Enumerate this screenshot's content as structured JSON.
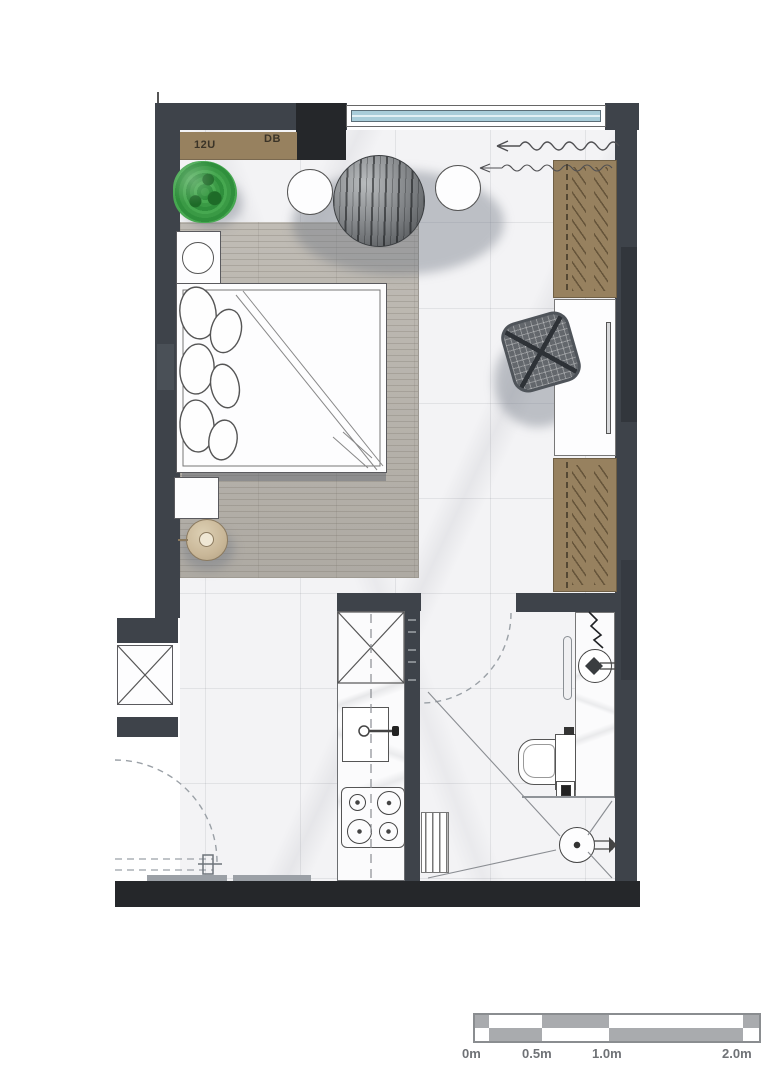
{
  "plan": {
    "type": "studio-apartment-floor-plan",
    "annotations": {
      "cabinet_left_label": "12U",
      "cabinet_right_label": "DB"
    },
    "scale_bar": {
      "labels": [
        "0m",
        "0.5m",
        "1.0m",
        "2.0m"
      ]
    },
    "colors": {
      "wall_gray": "#3e434a",
      "wall_black": "#25272a",
      "wardrobe_brown": "#97815f",
      "wood_floor": "#b7b3ac",
      "marble_floor": "#f3f3f5",
      "window_glass_blue": "#a9cdd9",
      "plant_green": "#2f8f3c",
      "table_sphere_gray": "#7d8083",
      "drawing_line": "#555555",
      "dashed_line_gray": "#9aa0a6",
      "scale_bar_gray": "#a9abae",
      "lamp_tan": "#c9b798"
    }
  }
}
